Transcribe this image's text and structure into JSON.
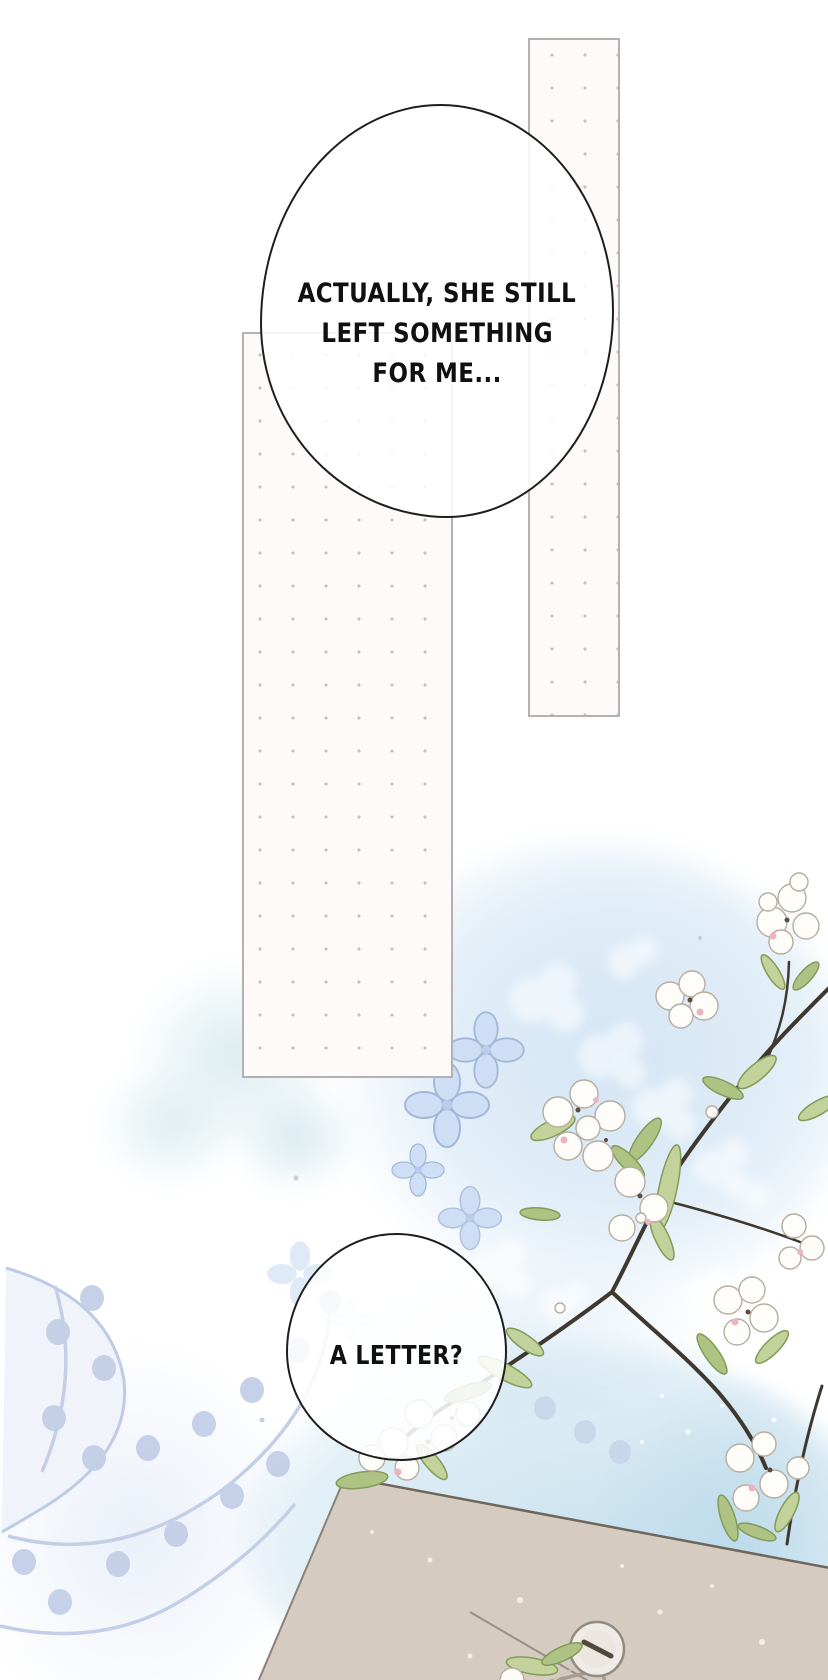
{
  "page": {
    "type": "comic-page"
  },
  "speech_bubbles": {
    "bubble1": {
      "line1": "ACTUALLY, SHE STILL",
      "line2": "LEFT SOMETHING",
      "line3": "FOR ME..."
    },
    "bubble2": {
      "line1": "A LETTER?"
    }
  },
  "colors": {
    "background": "#ffffff",
    "panel_fill": "#fdfaf9",
    "panel_border": "#b3b1b1",
    "panel_dot": "#c6c0c0",
    "bubble_outline": "#1e1e1e",
    "watercolor_blue": "#cbdef2",
    "sky_blue": "#c6dfec",
    "periwinkle_flora": "#c3cfe7",
    "envelope_tan": "#d5cbc0",
    "envelope_edge": "#6e665b",
    "leaf_green": "#c2d29a",
    "leaf_green_dark": "#adc283",
    "blossom_white": "#fefdf9",
    "blossom_outline": "#b6ad9f",
    "blossom_pink": "#ecb3c0",
    "branch_brown": "#3e382e"
  }
}
